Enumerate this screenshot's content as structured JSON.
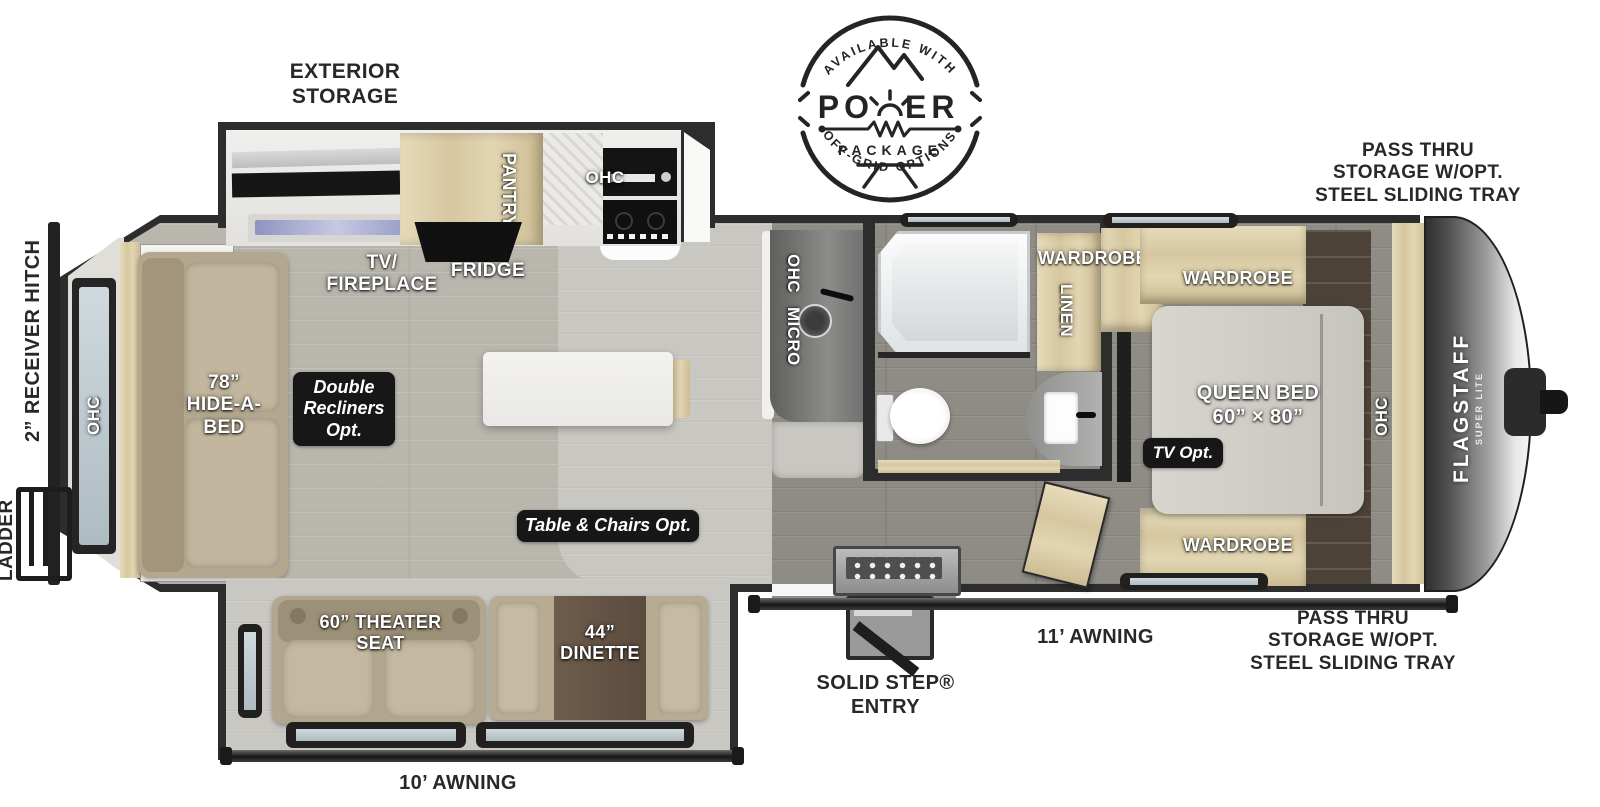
{
  "meta": {
    "title": "Flagstaff Super Lite travel trailer floorplan"
  },
  "colors": {
    "background": "#ffffff",
    "wall": "#2d2d2d",
    "floor_main": "#b8b6ad",
    "floor_bedroom": "#8f8c85",
    "floor_kitchen": "#c6c4bf",
    "cabinet_wood": "#d9cba6",
    "dark_wood": "#4d4238",
    "upholstery": "#b6aa92",
    "mattress": "#d2cfc9",
    "badge_bg": "#171717",
    "label_light": "#ffffff",
    "label_dark": "#282828",
    "window_glass": "#c7d2d7",
    "fireplace_glass": "#9aa0c8",
    "cap_metal": "#bfbfbf"
  },
  "logo": {
    "arc_top": "AVAILABLE WITH",
    "word_left": "PO",
    "word_right": "ER",
    "package": "PACKAGE",
    "arc_bottom": "OFF-GRID OPTIONS"
  },
  "brand": {
    "name": "FLAGSTAFF",
    "sub": "SUPER LITE"
  },
  "exterior": {
    "storage_label": "EXTERIOR\nSTORAGE",
    "pass_thru_top": "PASS THRU\nSTORAGE W/OPT.\nSTEEL SLIDING TRAY",
    "pass_thru_bottom": "PASS THRU\nSTORAGE W/OPT.\nSTEEL SLIDING TRAY",
    "receiver_hitch": "2” RECEIVER HITCH",
    "ladder": "LADDER",
    "awning_main": "11’ AWNING",
    "awning_slide": "10’ AWNING",
    "entry": "SOLID STEP®\nENTRY"
  },
  "interior": {
    "rear_ohc": "OHC",
    "hide_a_bed": "78”\nHIDE-A-\nBED",
    "tv_fireplace": "TV/\nFIREPLACE",
    "fridge": "FRIDGE",
    "pantry": "PANTRY",
    "kitchen_ohc": "OHC",
    "ohc_micro_1": "OHC",
    "ohc_micro_2": "MICRO",
    "wardrobe_hall": "WARDROBE",
    "linen": "LINEN",
    "wardrobe_top": "WARDROBE",
    "wardrobe_bottom": "WARDROBE",
    "queen_bed": "QUEEN BED\n60” × 80”",
    "bedroom_ohc": "OHC",
    "theater_seat": "60” THEATER\nSEAT",
    "dinette": "44”\nDINETTE"
  },
  "options": {
    "double_recliners": "Double\nRecliners\nOpt.",
    "table_chairs": "Table & Chairs Opt.",
    "tv_opt": "TV Opt."
  }
}
